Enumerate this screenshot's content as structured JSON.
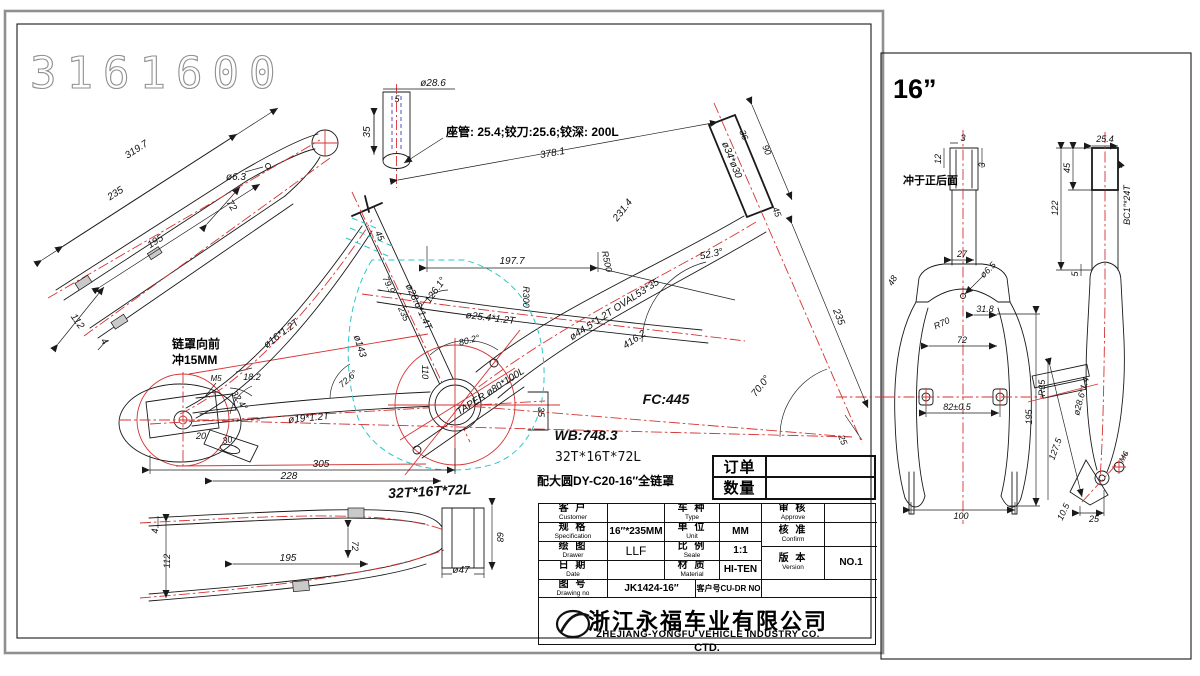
{
  "colors": {
    "line": "#1a1a1a",
    "red": "#d63333",
    "cyan": "#2bc7c7",
    "blue": "#3b3bd0",
    "gray_outline": "#8f8f8f"
  },
  "main_sheet": {
    "drawing_number": "3161600",
    "seatpost_note": "座管: 25.4;铰刀:25.6;铰深: 200L",
    "chaincover_note_1": "链罩向前",
    "chaincover_note_2": "冲15MM",
    "gear_spec": "32T*16T*72L",
    "gear_spec_2": "32T*16T*72L",
    "chaincover_spec": "配大圆DY-C20-16″全链罩",
    "order_label": "订单",
    "qty_label": "数量",
    "dims": {
      "seatstay_total": "319.7",
      "seatstay_235": "235",
      "seatstay_195": "195",
      "seatstay_72": "72",
      "seatstay_hole": "ø6.3",
      "seatstay_112": "112",
      "seatstay_4": "4",
      "seatpost_dia": "ø28.6",
      "seatpost_5": "5",
      "seatpost_35": "35",
      "toptube_378": "378.1",
      "head_36": "36",
      "head_90": "90",
      "head_dia": "ø34*ø30",
      "head_45": "45",
      "head_angle_52": "52.3°",
      "head_235": "235",
      "tt_231": "231.4",
      "tt_r500": "R500",
      "tt_197": "197.7",
      "tt_r300": "R300",
      "tt_angle_126": "126.1°",
      "midtube_dia": "ø25.4*1.2T",
      "seattube_dia": "ø28.6*1.4T",
      "seattube_79": "79.9",
      "seattube_235": "235",
      "seattube_45": "45",
      "seatstay_dia": "ø16*1.2T",
      "dropout_18": "18.2",
      "dropout_angle": "32.4°",
      "dropout_m5": "M5",
      "dropout_20": "20",
      "dropout_30": "30",
      "chainstay_dia": "ø19*1.2T",
      "bb_circle": "ø143",
      "bb_angle_72": "72.6°",
      "bb_110": "110",
      "bb_35": "35",
      "bb_taper": "TAPER ø80*100L",
      "bb_angle_80": "80.2°",
      "downtube_dia": "ø44.5*1.2T OVAL53*35",
      "downtube_416": "416.2",
      "fc": "FC:445",
      "wb": "WB:748.3",
      "head_angle_70": "70.0°",
      "fork_offset": "25",
      "cs_305": "305",
      "cs_228": "228",
      "cs_4": "4",
      "cs_112": "112",
      "cs_195": "195",
      "cs_72": "72",
      "cs_68": "68",
      "cs_47": "ø47"
    }
  },
  "title_block": {
    "customer_cn": "客 户",
    "customer_en": "Customer",
    "customer_val": "",
    "type_cn": "车 种",
    "type_en": "Type",
    "type_val": "",
    "approve_cn": "审 核",
    "approve_en": "Approve",
    "approve_val": "",
    "spec_cn": "规 格",
    "spec_en": "Specification",
    "spec_val": "16″*235MM",
    "unit_cn": "单 位",
    "unit_en": "Unit",
    "unit_val": "MM",
    "confirm_cn": "核 准",
    "confirm_en": "Confirm",
    "confirm_val": "",
    "drawer_cn": "绘 图",
    "drawer_en": "Drawer",
    "drawer_val": "LLF",
    "scale_cn": "比 例",
    "scale_en": "Seale",
    "scale_val": "1:1",
    "version_cn": "版 本",
    "version_en": "Version",
    "version_val": "NO.1",
    "date_cn": "日 期",
    "date_en": "Date",
    "date_val": "",
    "material_cn": "材 质",
    "material_en": "Material",
    "material_val": "HI-TEN",
    "drawno_cn": "图 号",
    "drawno_en": "Drawing no",
    "drawno_val": "JK1424-16″",
    "custno_label": "客户号CU-DR NO",
    "custno_val": "",
    "company_cn": "浙江永福车业有限公司",
    "company_en": "ZHEJIANG-YONGFU VEHICLE INDUSTRY CO.",
    "company_en_2": "CTD."
  },
  "fork_sheet": {
    "size_label": "16”",
    "punch_note": "冲于正后面",
    "dims": {
      "top_3a": "3",
      "top_12": "12",
      "top_3b": "3",
      "crown_27": "27",
      "crown_hole": "ø6.5",
      "crown_48": "48",
      "crown_318": "31.8",
      "blade_r70": "R70",
      "inner_72": "72",
      "axle_82": "82±0.5",
      "len_195": "195",
      "width_100": "100",
      "steer_254": "25.4",
      "steer_45": "45",
      "steer_122": "122",
      "steer_thread": "BC1″*24T",
      "steer_5": "5",
      "side_r35": "R35",
      "side_dia": "ø28.6*1.4",
      "side_1275": "127.5",
      "side_105": "10.5",
      "side_25": "25",
      "side_m6": "M6"
    }
  }
}
